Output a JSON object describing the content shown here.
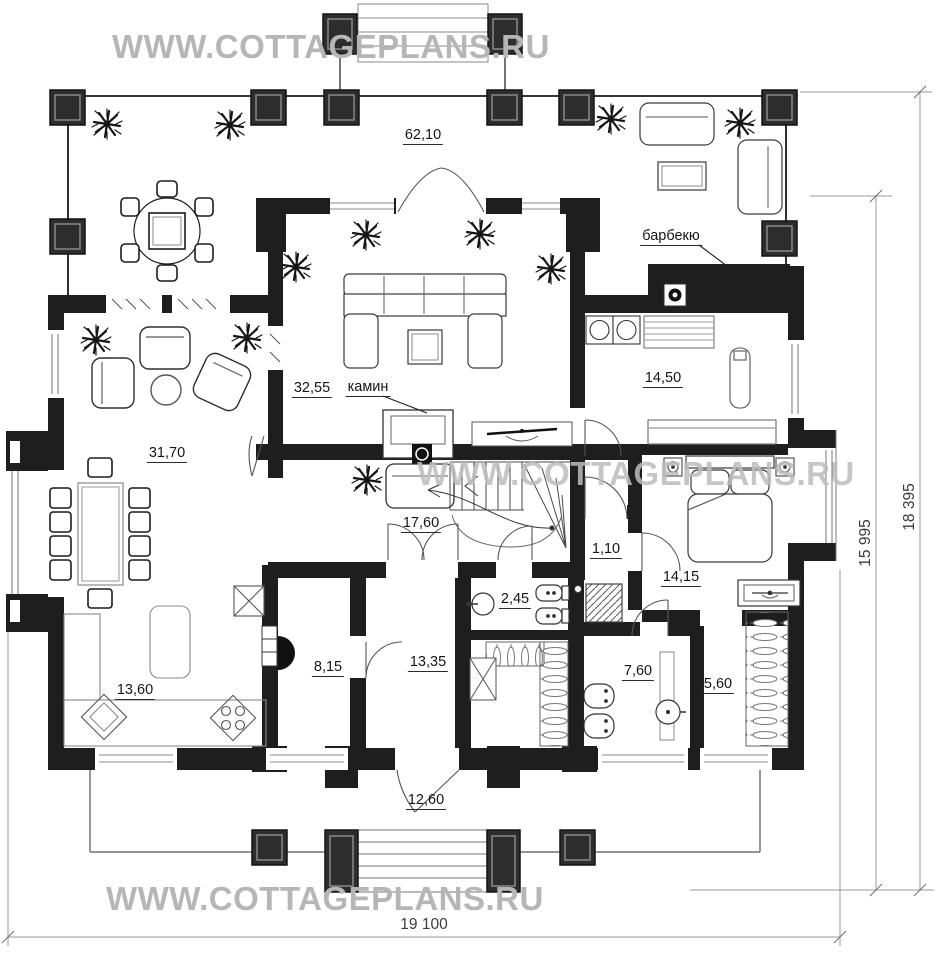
{
  "watermark": {
    "text": "WWW.COTTAGEPLANS.RU"
  },
  "rooms": {
    "terrace_top": "62,10",
    "living_room": "32,55",
    "sauna_room": "14,50",
    "dining_room": "31,70",
    "hall": "17,60",
    "lobby": "1,10",
    "bedroom": "14,15",
    "wc": "2,45",
    "boiler_room": "8,15",
    "cabinet": "13,35",
    "bathroom": "7,60",
    "wardrobe": "5,60",
    "kitchen": "13,60",
    "porch_bottom": "12,60"
  },
  "annotations": {
    "fireplace": "камин",
    "barbecue": "барбекю"
  },
  "dimensions": {
    "total_width": "19 100",
    "height_outer": "18 395",
    "height_inner": "15 995"
  },
  "colors": {
    "wall": "#1e1e1e",
    "column_fill": "#2d2d2d",
    "watermark": "#b6b6b6",
    "dimension_line": "#9a9a9a"
  }
}
